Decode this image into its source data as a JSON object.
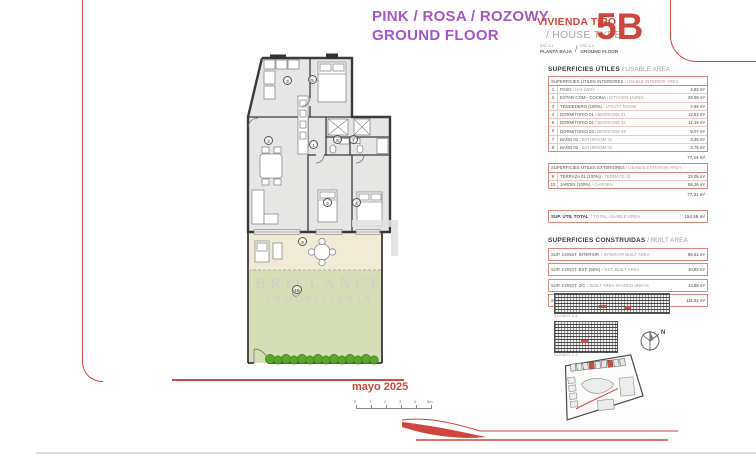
{
  "header": {
    "title_line1": "PINK / ROSA / ROZOWY",
    "title_line2": "GROUND FLOOR",
    "vivienda_tipo": "VIVIENDA TIPO",
    "house_type": "/ HOUSE TYPE",
    "esc_left": "ESC 3-4",
    "planta_baja": "PLANTA BAJA",
    "slash": "/",
    "esc_right": "ESC 3-4",
    "ground_floor": "GROUND FLOOR",
    "unit_code": "5B"
  },
  "usable": {
    "title_es": "SUPERFICIES ÚTILES",
    "title_en": "/ USABLE AREA",
    "interior_header_es": "SUPERFICIES ÚTILES INTERIORES",
    "interior_header_en": "/ USABLE INTERIOR AREA",
    "interior_rows": [
      {
        "num": "1",
        "label_es": "PASO",
        "label_en": "/ HALLWAY",
        "value": "4,92 m²"
      },
      {
        "num": "2",
        "label_es": "ESTAR-COM.- COCINA",
        "label_en": "/ KITCHEN-LIVING",
        "value": "29,58 m²"
      },
      {
        "num": "3",
        "label_es": "TENDEDERO (100%)",
        "label_en": "/ UTILITY ROOM",
        "value": "2,66 m²"
      },
      {
        "num": "4",
        "label_es": "DORMITORIO 01",
        "label_en": "/ BEDROOM 01",
        "value": "12,63 m²"
      },
      {
        "num": "5",
        "label_es": "DORMITORIO 02",
        "label_en": "/ BEDROOM 02",
        "value": "11,18 m²"
      },
      {
        "num": "6",
        "label_es": "DORMITORIO 03",
        "label_en": "/ BEDROOM 03",
        "value": "9,07 m²"
      },
      {
        "num": "7",
        "label_es": "BAÑO 01",
        "label_en": "/ BATHROOM 01",
        "value": "3,45 m²"
      },
      {
        "num": "8",
        "label_es": "BAÑO 02",
        "label_en": "/ BATHROOM 02",
        "value": "3,75 m²"
      }
    ],
    "interior_total": "77,24 m²",
    "exterior_header_es": "SUPERFICIES ÚTILES EXTERIORES",
    "exterior_header_en": "/ USABLE EXTERIOR AREA",
    "exterior_rows": [
      {
        "num": "9",
        "label_es": "TERRAZA 01 (100%)",
        "label_en": "/ TERRACE 01",
        "value": "22,05 m²"
      },
      {
        "num": "10",
        "label_es": "JARDÍN (100%)",
        "label_en": "/ GARDEN",
        "value": "55,26 m²"
      }
    ],
    "exterior_total": "77,31 m²",
    "total_label_es": "SUP. ÚTIL TOTAL",
    "total_label_en": "/ TOTAL USABLE AREA",
    "total_value": "154,55 m²"
  },
  "built": {
    "title_es": "SUPERFICIES CONSTRUIDAS",
    "title_en": "/ BUILT AREA",
    "rows": [
      {
        "label_es": "SUP. CONST. INTERIOR",
        "label_en": "/ INTERIOR BUILT AREA",
        "value": "86,51 m²"
      },
      {
        "label_es": "SUP. CONST. EXT. (50%)",
        "label_en": "/ EXT. BUILT AREA",
        "value": "10,83 m²"
      },
      {
        "label_es": "SUP. CONST. Z/C",
        "label_en": "/ BUILT AREA SHARED AREAS",
        "value": "13,58 m²"
      },
      {
        "label_es": "SUP. CONST. TOTAL",
        "label_en": "/ TOTAL BUILT AREA",
        "value": "111,52 m²"
      }
    ]
  },
  "plan": {
    "room_numbers": [
      "1",
      "2",
      "3",
      "4",
      "5",
      "6",
      "7",
      "8",
      "9",
      "10"
    ],
    "date": "mayo 2025",
    "scale_labels": [
      "0",
      "1",
      "2",
      "3",
      "4",
      "5m"
    ],
    "north_label": "N"
  },
  "watermark": {
    "line1": "BRILLANCE",
    "line2": "INMOBILIARIA"
  },
  "site": {
    "elevation1_caption": "ALZADO 3-4",
    "elevation2_caption": "ALZADO 1-2"
  },
  "colors": {
    "accent_red": "#d0453c",
    "purple": "#a458c5",
    "table_border": "#d98880",
    "terrace": "#f0ead6",
    "garden": "#d5deb5",
    "hedge": "#56a12f"
  }
}
